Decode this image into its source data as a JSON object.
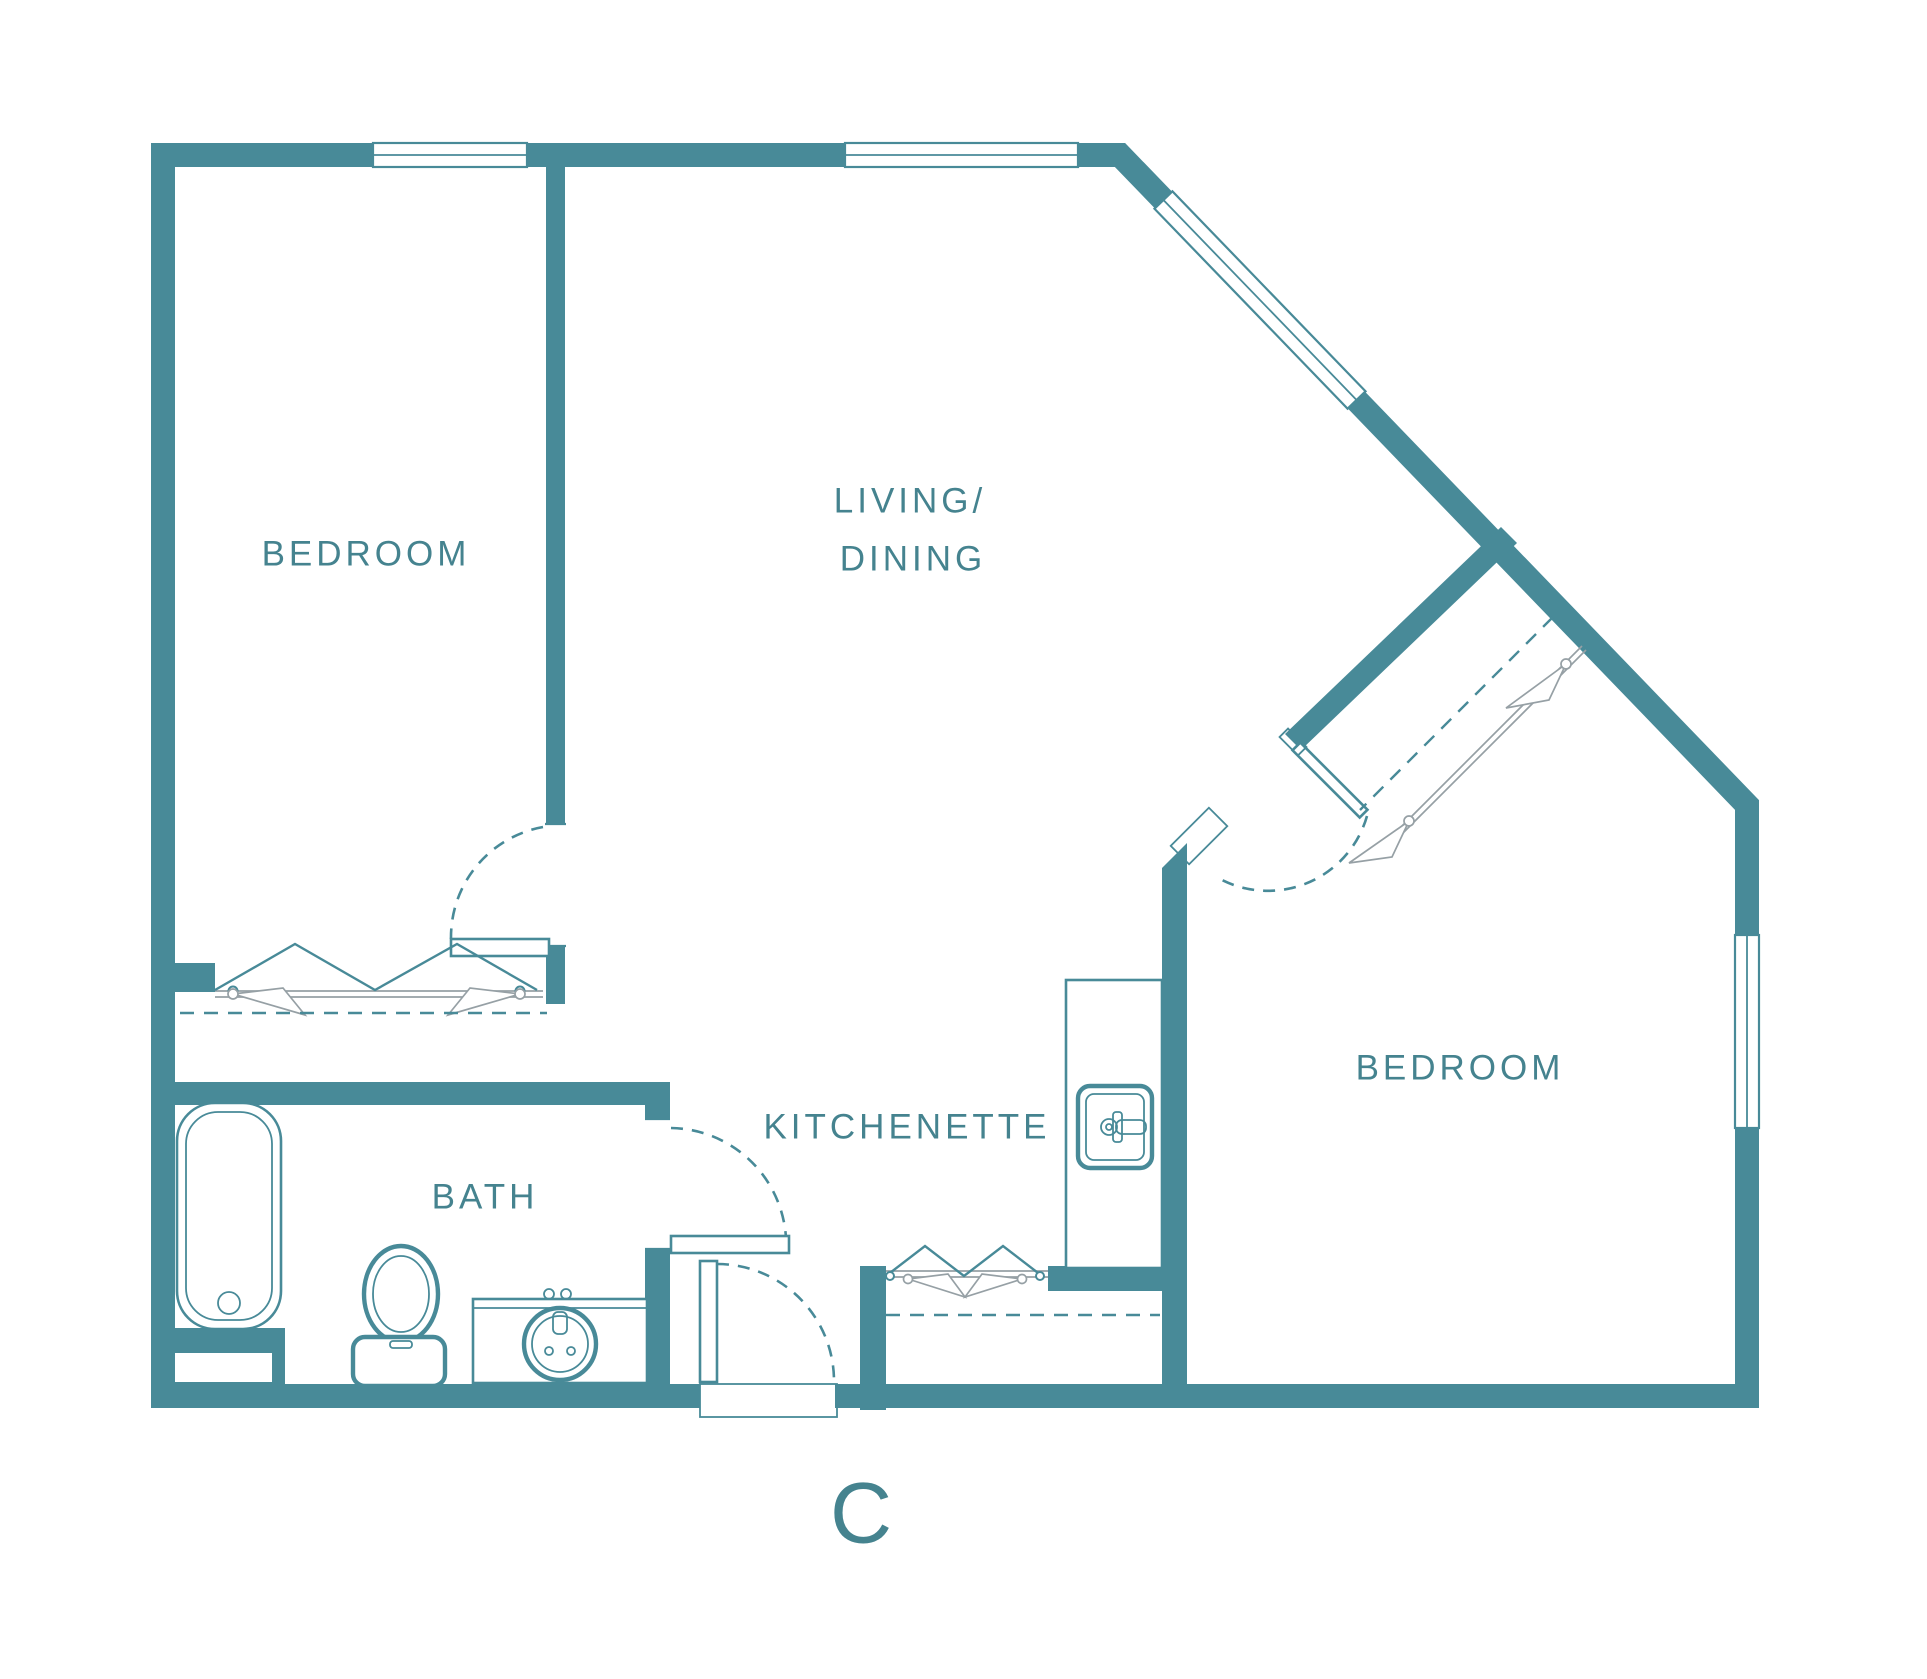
{
  "plan": {
    "unit_label": "C",
    "rooms": {
      "bedroom_left": "BEDROOM",
      "living_dining_line1": "LIVING/",
      "living_dining_line2": "DINING",
      "kitchenette": "KITCHENETTE",
      "bath": "BATH",
      "bedroom_right": "BEDROOM"
    },
    "colors": {
      "wall_teal": "#488A98",
      "label_teal": "#45838F",
      "accessory_gray": "#96A0A5",
      "background": "#FFFFFF"
    },
    "fixtures": {
      "bathtub": "bathtub-icon",
      "toilet": "toilet-icon",
      "vanity_sink": "bathroom-sink-icon",
      "kitchen_sink": "kitchen-sink-icon",
      "hangers": "clothes-hanger-icon",
      "windows": "window-symbol",
      "door_swings": "door-swing-arc"
    }
  }
}
